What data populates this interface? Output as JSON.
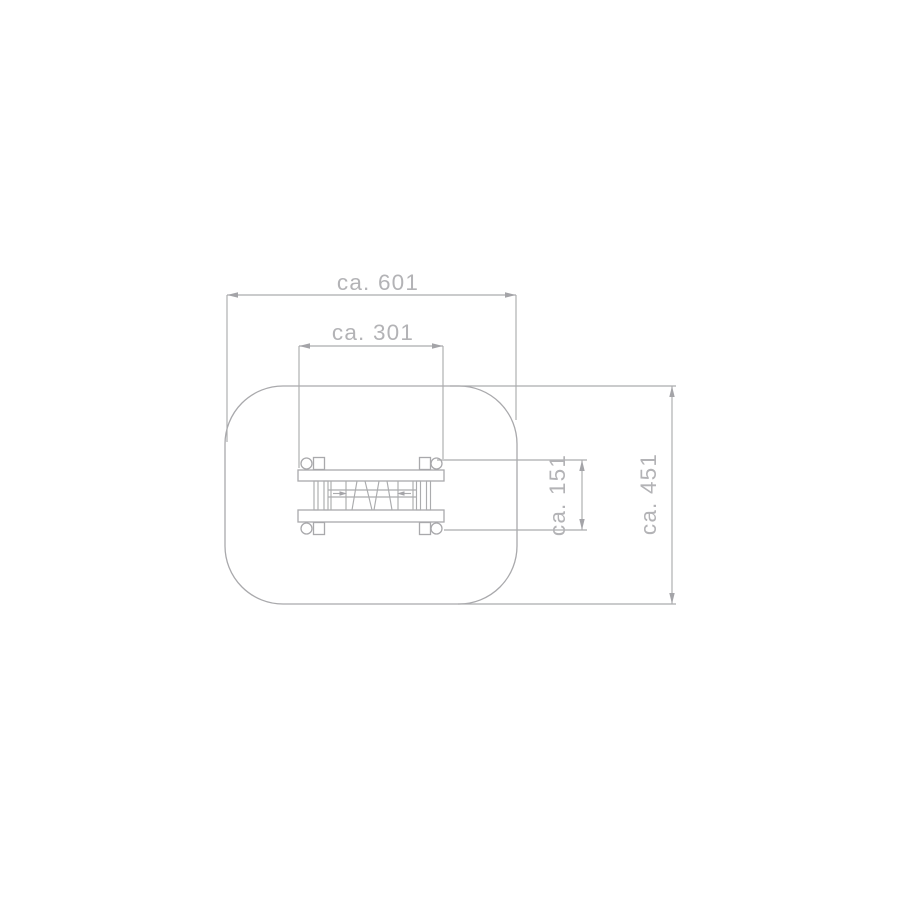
{
  "diagram": {
    "title": "playground-equipment-plan-view",
    "dimensions": [
      {
        "id": "safety-zone-width",
        "label": "ca. 601"
      },
      {
        "id": "equipment-width",
        "label": "ca. 301"
      },
      {
        "id": "equipment-depth",
        "label": "ca. 151"
      },
      {
        "id": "safety-zone-depth",
        "label": "ca. 451"
      }
    ],
    "colors": {
      "line": "#a9a9ac",
      "text": "#b3b3b6",
      "background": "#ffffff"
    }
  }
}
